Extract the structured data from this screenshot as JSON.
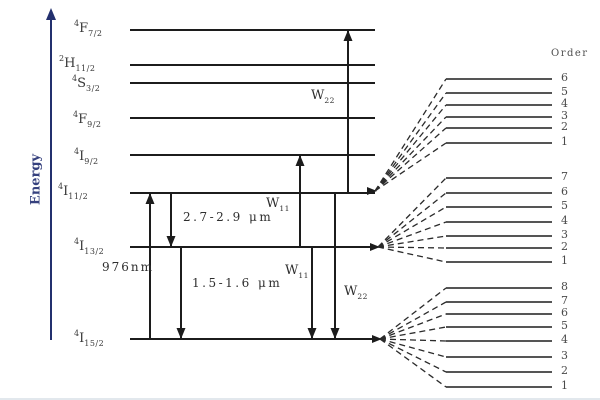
{
  "energy_axis": {
    "label": "Energy",
    "x": 51,
    "y_top": 8,
    "y_bottom": 340,
    "label_pos": {
      "left": 6,
      "top": 172
    }
  },
  "level_line": {
    "x_start": 130,
    "x_end": 375
  },
  "levels": [
    {
      "id": "4f7-2",
      "sup": "4",
      "letter": "F",
      "sub": "7/2",
      "y": 30,
      "label_left": 74,
      "label_top": 19
    },
    {
      "id": "2h11-2",
      "sup": "2",
      "letter": "H",
      "sub": "11/2",
      "y": 65,
      "label_left": 59,
      "label_top": 54
    },
    {
      "id": "4s3-2",
      "sup": "4",
      "letter": "S",
      "sub": "3/2",
      "y": 83,
      "label_left": 72,
      "label_top": 74
    },
    {
      "id": "4f9-2",
      "sup": "4",
      "letter": "F",
      "sub": "9/2",
      "y": 118,
      "label_left": 73,
      "label_top": 110
    },
    {
      "id": "4i9-2",
      "sup": "4",
      "letter": "I",
      "sub": "9/2",
      "y": 155,
      "label_left": 74,
      "label_top": 147
    },
    {
      "id": "4i11-2",
      "sup": "4",
      "letter": "I",
      "sub": "11/2",
      "y": 193,
      "label_left": 58,
      "label_top": 182
    },
    {
      "id": "4i13-2",
      "sup": "4",
      "letter": "I",
      "sub": "13/2",
      "y": 247,
      "label_left": 74,
      "label_top": 237
    },
    {
      "id": "4i15-2",
      "sup": "4",
      "letter": "I",
      "sub": "15/2",
      "y": 339,
      "label_left": 74,
      "label_top": 329
    }
  ],
  "transitions": [
    {
      "id": "pump-976nm",
      "x": 150,
      "y_from": 339,
      "y_to": 193
    },
    {
      "id": "emission-2-7-2-9um",
      "x": 171,
      "y_from": 193,
      "y_to": 247
    },
    {
      "id": "emission-1-5-1-6um",
      "x": 181,
      "y_from": 247,
      "y_to": 339
    },
    {
      "id": "etu-w11-up",
      "x": 300,
      "y_from": 247,
      "y_to": 155
    },
    {
      "id": "etu-w11-down",
      "x": 312,
      "y_from": 247,
      "y_to": 339
    },
    {
      "id": "etu-w22-up",
      "x": 348,
      "y_from": 193,
      "y_to": 30
    },
    {
      "id": "etu-w22-down",
      "x": 335,
      "y_from": 193,
      "y_to": 339
    }
  ],
  "annotations": [
    {
      "id": "label-976nm",
      "kind": "plain",
      "cls": "nm",
      "text": "976nm",
      "left": 102,
      "top": 260
    },
    {
      "id": "label-2-7-2-9um",
      "kind": "plain",
      "cls": "wave",
      "text": "2.7-2.9 μm",
      "left": 183,
      "top": 210
    },
    {
      "id": "label-1-5-1-6um",
      "kind": "plain",
      "cls": "wave",
      "text": "1.5-1.6 μm",
      "left": 192,
      "top": 276
    },
    {
      "id": "label-w22-upper",
      "kind": "wsub",
      "base": "W",
      "sub": "22",
      "left": 311,
      "top": 88
    },
    {
      "id": "label-w11-upper",
      "kind": "wsub",
      "base": "W",
      "sub": "11",
      "left": 266,
      "top": 196
    },
    {
      "id": "label-w11-lower",
      "kind": "wsub",
      "base": "W",
      "sub": "11",
      "left": 285,
      "top": 263
    },
    {
      "id": "label-w22-lower",
      "kind": "wsub",
      "base": "W",
      "sub": "22",
      "left": 344,
      "top": 284
    }
  ],
  "stark": {
    "header": "Order",
    "header_pos": {
      "left": 551,
      "top": 48
    },
    "line_x_start": 446,
    "line_x_end": 552,
    "label_x": 561,
    "groups": [
      {
        "id": "stark-4i11-2",
        "origin_x": 374,
        "origin_y": 191,
        "levels": [
          {
            "order": "6",
            "y": 79
          },
          {
            "order": "5",
            "y": 93
          },
          {
            "order": "4",
            "y": 105
          },
          {
            "order": "3",
            "y": 117
          },
          {
            "order": "2",
            "y": 128
          },
          {
            "order": "1",
            "y": 143
          }
        ]
      },
      {
        "id": "stark-4i13-2",
        "origin_x": 377,
        "origin_y": 247,
        "levels": [
          {
            "order": "7",
            "y": 178
          },
          {
            "order": "6",
            "y": 193
          },
          {
            "order": "5",
            "y": 207
          },
          {
            "order": "4",
            "y": 222
          },
          {
            "order": "3",
            "y": 236
          },
          {
            "order": "2",
            "y": 248
          },
          {
            "order": "1",
            "y": 262
          }
        ]
      },
      {
        "id": "stark-4i15-2",
        "origin_x": 379,
        "origin_y": 339,
        "levels": [
          {
            "order": "8",
            "y": 288
          },
          {
            "order": "7",
            "y": 302
          },
          {
            "order": "6",
            "y": 314
          },
          {
            "order": "5",
            "y": 327
          },
          {
            "order": "4",
            "y": 341
          },
          {
            "order": "3",
            "y": 357
          },
          {
            "order": "2",
            "y": 372
          },
          {
            "order": "1",
            "y": 387
          }
        ]
      }
    ]
  },
  "colors": {
    "line": "#1c1c1c",
    "stark_line": "#3d3d3d",
    "dash": "#2b2b2b",
    "axis": "#23306e",
    "axis_label": "#36417e",
    "frame": "#e2e8ed",
    "background": "#ffffff"
  }
}
